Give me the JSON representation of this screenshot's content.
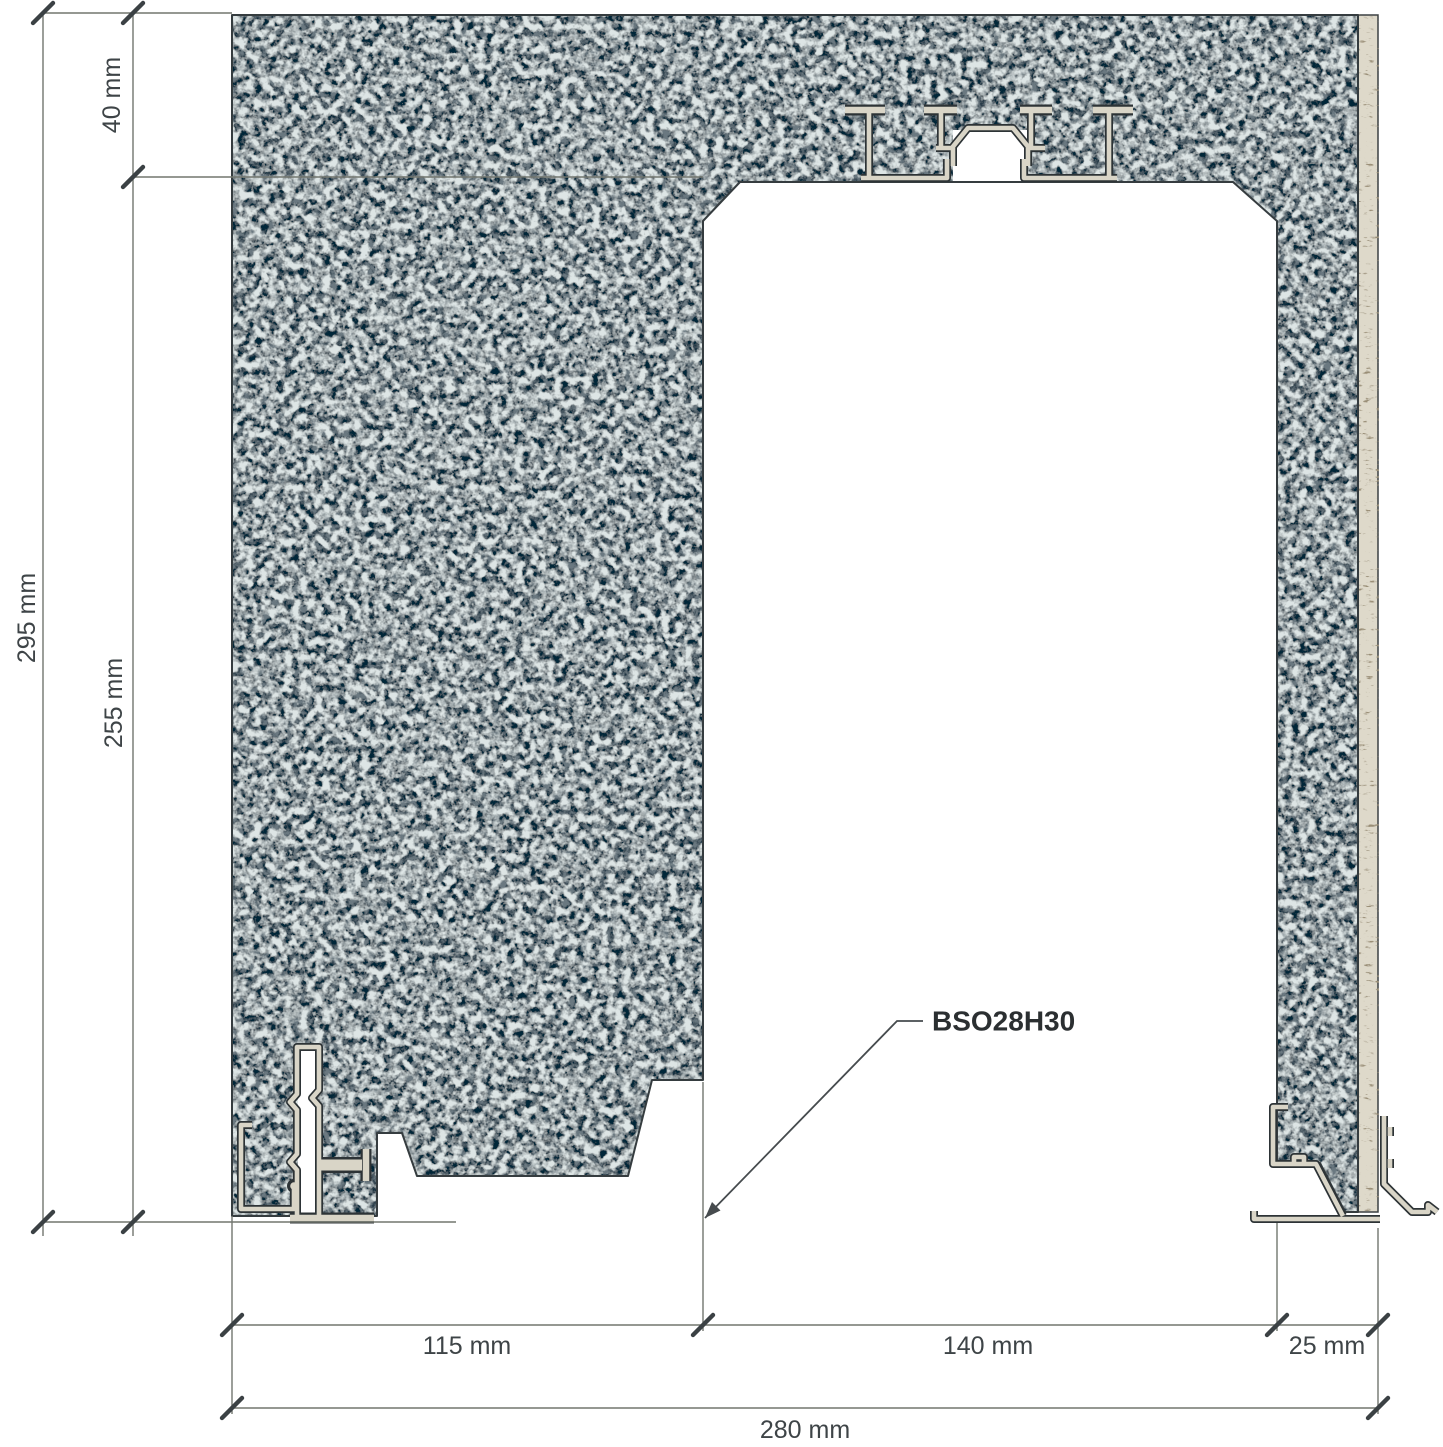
{
  "label": {
    "text": "BSO28H30"
  },
  "dims": {
    "top_band": "40 mm",
    "overall_height": "295 mm",
    "opening_height": "255 mm",
    "left_wall": "115 mm",
    "opening_width": "140 mm",
    "right_wall": "25 mm",
    "overall_width": "280 mm"
  },
  "colors": {
    "material_base": "#6a7880",
    "material_speckle_dark": "#2e3a40",
    "material_speckle_light": "#b8c4c4",
    "board_base": "#ded9ca",
    "board_grain": "#564c3a",
    "profile_fill": "#d9d5c7",
    "profile_outline": "#2d3336",
    "dimension_line": "#72766f",
    "text": "#3e4447",
    "background": "#ffffff"
  }
}
